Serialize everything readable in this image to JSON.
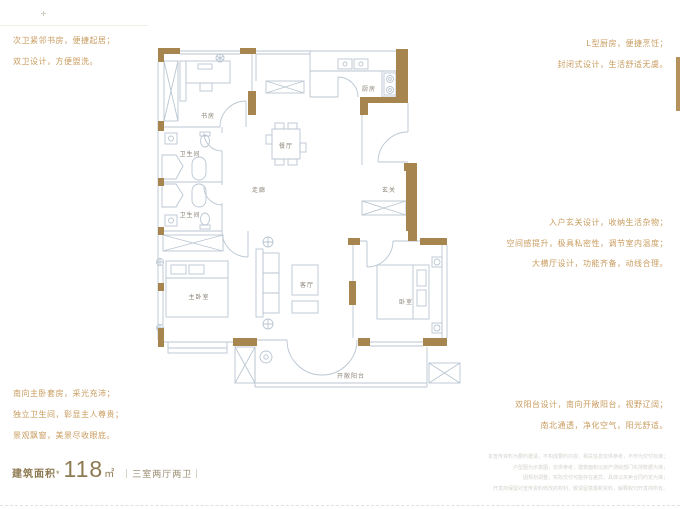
{
  "side_notes": {
    "top_left": [
      "次卫紧邻书房，便捷起居；",
      "双卫设计，方便盥洗。"
    ],
    "top_right": [
      "L型厨房，便捷烹饪；",
      "封闭式设计，生活舒适无虞。"
    ],
    "mid_right": [
      "入户玄关设计，收纳生活杂物；",
      "空间感提升，极具私密性，调节室内温度；",
      "大横厅设计，功能齐备，动线合理。"
    ],
    "bottom_left": [
      "南向主卧套房，采光充沛；",
      "独立卫生间，彰显主人尊贵；",
      "景观飘窗，美景尽收眼底。"
    ],
    "bottom_right": [
      "双阳台设计，南向开敞阳台，视野辽阔；",
      "南北通透，净化空气，阳光舒适。"
    ]
  },
  "plan_rooms": {
    "study": "书房",
    "bath_upper": "卫生间",
    "bath_lower": "卫生间",
    "dining": "餐厅",
    "kitchen": "厨房",
    "corridor": "走廊",
    "foyer": "玄关",
    "master": "主卧室",
    "living": "客厅",
    "bedroom": "卧室",
    "balcony": "开敞阳台"
  },
  "footer": {
    "area_label": "建筑面积",
    "area_star": "*",
    "area_value": "118",
    "area_unit": "㎡",
    "layout_tag": "｜三室两厅两卫｜",
    "disclaimer": [
      "本宣传资料为要约邀请，不构成要约内容，相关信息仅供参考，不作为交付标准；",
      "户型图为示意图，仅供参考，建筑面积以房产测绘部门实测数据为准；",
      "因规划调整，实际交付可能存在差异，具体以买卖合同约定为准；",
      "开发商保留对宣传资料修改的权利，敬请留意最新资料，解释权归开发商所有。"
    ]
  },
  "colors": {
    "wall": "#a6854f",
    "line": "#b9c6d2",
    "accent": "#c89c5f",
    "room_label": "#8b8377"
  }
}
